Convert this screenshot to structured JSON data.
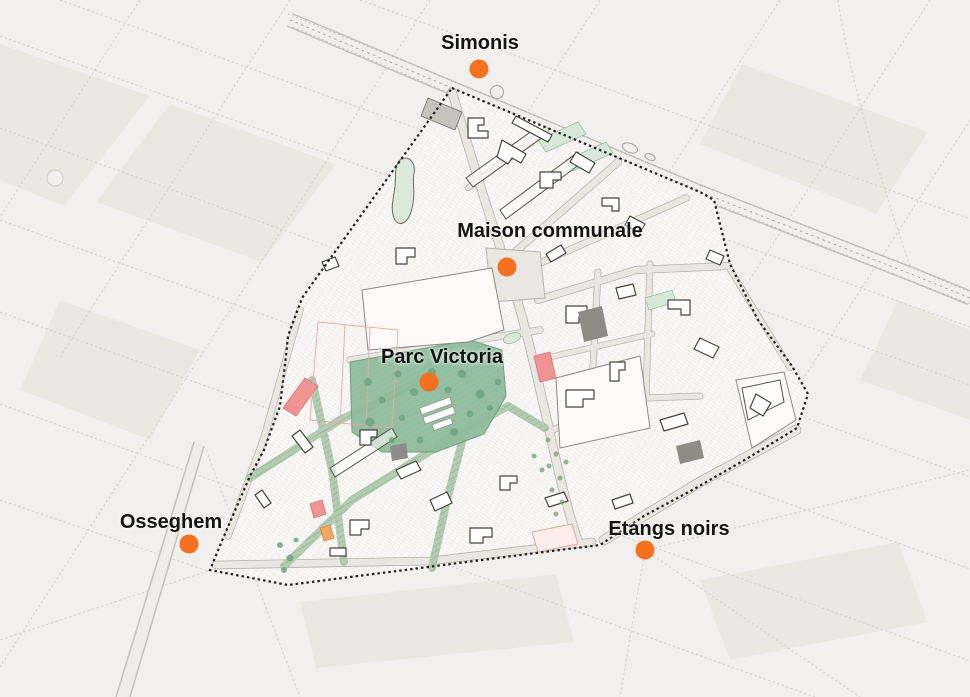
{
  "markers": [
    {
      "id": "simonis",
      "label": "Simonis",
      "dot": {
        "x": 479,
        "y": 69
      },
      "label_pos": {
        "x": 480,
        "y": 31
      }
    },
    {
      "id": "maison-communale",
      "label": "Maison communale",
      "dot": {
        "x": 507,
        "y": 267
      },
      "label_pos": {
        "x": 550,
        "y": 219
      }
    },
    {
      "id": "parc-victoria",
      "label": "Parc Victoria",
      "dot": {
        "x": 429,
        "y": 382
      },
      "label_pos": {
        "x": 442,
        "y": 345
      }
    },
    {
      "id": "osseghem",
      "label": "Osseghem",
      "dot": {
        "x": 189,
        "y": 544
      },
      "label_pos": {
        "x": 171,
        "y": 510
      }
    },
    {
      "id": "etangs-noirs",
      "label": "Etangs noirs",
      "dot": {
        "x": 645,
        "y": 550
      },
      "label_pos": {
        "x": 669,
        "y": 517
      }
    }
  ],
  "colors": {
    "marker_orange": "#f4711f",
    "label_text": "#141414",
    "park_green": "#8fbc9d",
    "corridor_green": "#b3ccb1",
    "building_red": "#f09393",
    "building_orange": "#f0a964",
    "background": "#f2f0ee"
  }
}
